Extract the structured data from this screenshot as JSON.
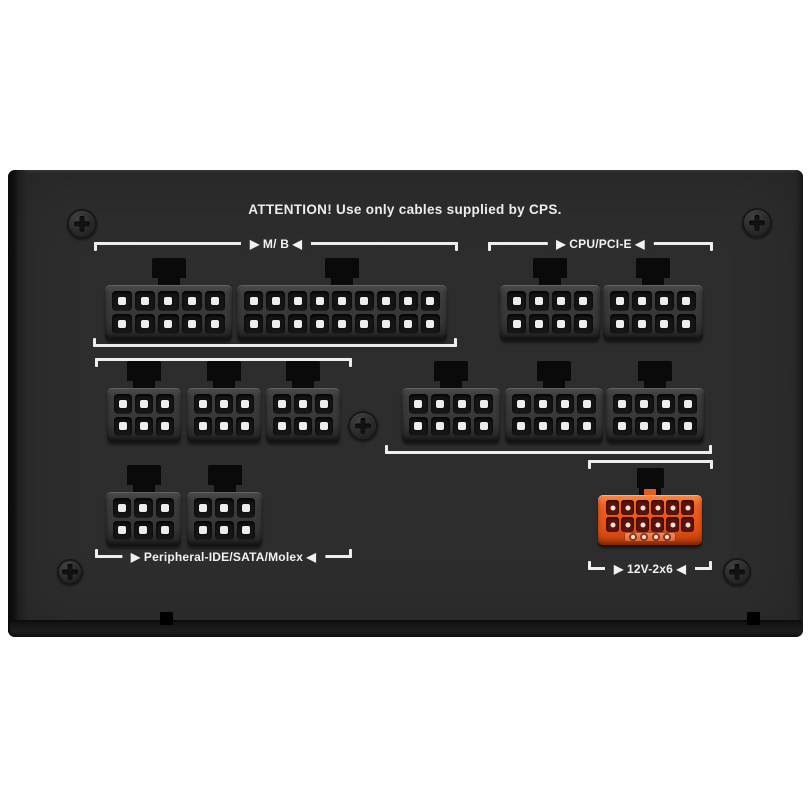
{
  "scene": {
    "attention_text": "ATTENTION! Use only cables supplied by CPS.",
    "background": "#ffffff",
    "panel_color": "#2d2d2d",
    "line_color": "#eeeeee",
    "pin_color": "#ededed",
    "tab_color": "#0a0a0a",
    "accent_orange": "#e85a1e"
  },
  "labels": {
    "mb": "▶ M/ B ◀",
    "cpu": "▶ CPU/PCI-E ◀",
    "peripheral": "▶ Peripheral-IDE/SATA/Molex ◀",
    "v12": "▶ 12V-2x6 ◀"
  },
  "connectors": [
    {
      "name": "mb-10pin",
      "cols": 5,
      "rows": 2,
      "x": 105,
      "y": 285,
      "w": 127,
      "h": 55,
      "style": "gray"
    },
    {
      "name": "mb-18pin",
      "cols": 9,
      "rows": 2,
      "x": 237,
      "y": 285,
      "w": 210,
      "h": 55,
      "style": "gray"
    },
    {
      "name": "cpu-pcie-8pin-1",
      "cols": 4,
      "rows": 2,
      "x": 500,
      "y": 285,
      "w": 100,
      "h": 55,
      "style": "gray"
    },
    {
      "name": "cpu-pcie-8pin-2",
      "cols": 4,
      "rows": 2,
      "x": 603,
      "y": 285,
      "w": 100,
      "h": 55,
      "style": "gray"
    },
    {
      "name": "peripheral-6pin-1",
      "cols": 3,
      "rows": 2,
      "x": 107,
      "y": 388,
      "w": 74,
      "h": 54,
      "style": "gray"
    },
    {
      "name": "peripheral-6pin-2",
      "cols": 3,
      "rows": 2,
      "x": 187,
      "y": 388,
      "w": 74,
      "h": 54,
      "style": "gray"
    },
    {
      "name": "peripheral-6pin-3",
      "cols": 3,
      "rows": 2,
      "x": 266,
      "y": 388,
      "w": 74,
      "h": 54,
      "style": "gray"
    },
    {
      "name": "cpu-pcie-8pin-3",
      "cols": 4,
      "rows": 2,
      "x": 402,
      "y": 388,
      "w": 98,
      "h": 54,
      "style": "gray"
    },
    {
      "name": "cpu-pcie-8pin-4",
      "cols": 4,
      "rows": 2,
      "x": 505,
      "y": 388,
      "w": 98,
      "h": 54,
      "style": "gray"
    },
    {
      "name": "cpu-pcie-8pin-5",
      "cols": 4,
      "rows": 2,
      "x": 606,
      "y": 388,
      "w": 98,
      "h": 54,
      "style": "gray"
    },
    {
      "name": "peripheral-6pin-4",
      "cols": 3,
      "rows": 2,
      "x": 106,
      "y": 492,
      "w": 75,
      "h": 54,
      "style": "gray"
    },
    {
      "name": "peripheral-6pin-5",
      "cols": 3,
      "rows": 2,
      "x": 187,
      "y": 492,
      "w": 75,
      "h": 54,
      "style": "gray"
    },
    {
      "name": "12v-2x6",
      "cols": 6,
      "rows": 2,
      "x": 598,
      "y": 495,
      "w": 104,
      "h": 50,
      "style": "orange",
      "sense_pins": 4
    }
  ],
  "brackets": [
    {
      "name": "mb-top",
      "x1": 94,
      "x2": 458,
      "y": 242,
      "tick": "down",
      "label": "mb"
    },
    {
      "name": "cpu-top",
      "x1": 488,
      "x2": 713,
      "y": 242,
      "tick": "down",
      "label": "cpu"
    },
    {
      "name": "mb-bottom",
      "x1": 93,
      "x2": 457,
      "y": 344,
      "tick": "up"
    },
    {
      "name": "peripheral-top",
      "x1": 95,
      "x2": 352,
      "y": 358,
      "tick": "down"
    },
    {
      "name": "cpu-bottom",
      "x1": 385,
      "x2": 712,
      "y": 451,
      "tick": "up"
    },
    {
      "name": "12v-top",
      "x1": 588,
      "x2": 713,
      "y": 460,
      "tick": "down"
    },
    {
      "name": "peripheral-bottom",
      "x1": 95,
      "x2": 352,
      "y": 555,
      "tick": "up",
      "label": "peripheral"
    },
    {
      "name": "12v-bottom",
      "x1": 588,
      "x2": 712,
      "y": 567,
      "tick": "up",
      "label": "v12"
    }
  ],
  "screws": [
    {
      "x": 82,
      "y": 224,
      "r": 15
    },
    {
      "x": 757,
      "y": 223,
      "r": 15
    },
    {
      "x": 363,
      "y": 426,
      "r": 15
    },
    {
      "x": 70,
      "y": 572,
      "r": 13
    },
    {
      "x": 737,
      "y": 572,
      "r": 14
    }
  ],
  "notches": [
    {
      "x": 160,
      "y": 612,
      "w": 13,
      "h": 13
    },
    {
      "x": 747,
      "y": 612,
      "w": 13,
      "h": 13
    }
  ]
}
